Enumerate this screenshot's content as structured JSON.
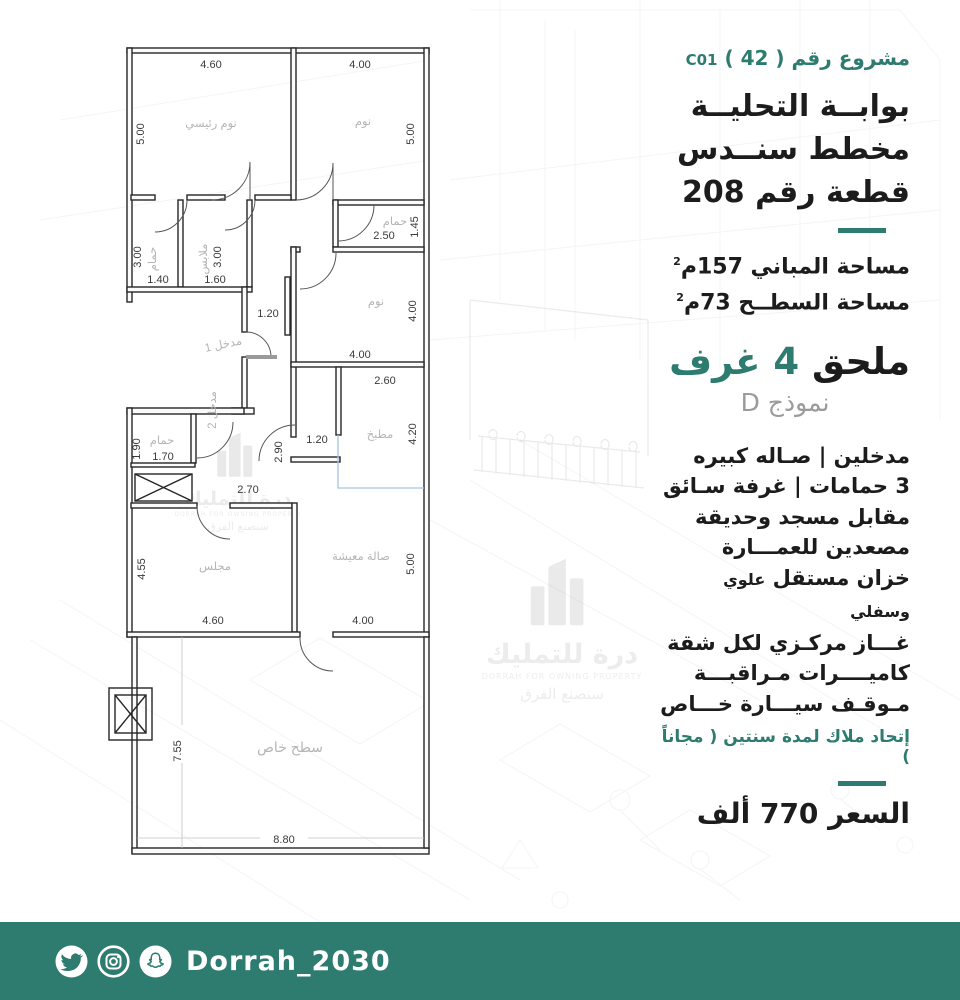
{
  "accent": "#2e7b70",
  "plan": {
    "rooms": {
      "master": "نوم رئيسي",
      "bed": "نوم",
      "bath": "حمام",
      "closet": "ملابس",
      "kitchen": "مطبخ",
      "entrance1": "مدخل 1",
      "entrance2": "مدخل 2",
      "majlis": "مجلس",
      "living": "صالة معيشة",
      "roof": "سطح خاص"
    },
    "dims": {
      "m_top": "4.60",
      "m_left": "5.00",
      "b_top": "4.00",
      "b_right": "5.00",
      "wc1_h": "3.00",
      "wc1_w": "1.40",
      "cl_h": "3.00",
      "cl_w": "1.60",
      "wc2_w": "2.50",
      "wc2_h": "1.45",
      "mb_h": "4.00",
      "mb_w": "4.00",
      "k_w": "2.60",
      "k_h": "4.20",
      "ent_w": "1.20",
      "hall_h": "2.90",
      "hall_gap": "1.20",
      "hall_w": "2.70",
      "wc3_h": "1.90",
      "wc3_w": "1.70",
      "mj_h": "4.55",
      "mj_w": "4.60",
      "lv_h": "5.00",
      "lv_w": "4.00",
      "rf_h": "7.55",
      "rf_w": "8.80"
    }
  },
  "panel": {
    "project_ar": "مشروع رقم ( 42 )",
    "project_code": "C01",
    "title1": "بوابــة التحليــة",
    "title2": "مخطط سنــدس",
    "title3": "قطعة رقم 208",
    "area1": "مساحة المباني 157م",
    "area1_sup": "2",
    "area2": "مساحة السطــح 73م",
    "area2_sup": "2",
    "annex_black": "ملحق",
    "annex_teal": "4 غرف",
    "model": "نموذج D",
    "features": [
      "مدخلين  |  صـاله كبيره",
      "3 حمامات | غرفة سـائق",
      "مقابل مسجد وحديقة",
      "مصعدين  للعمـــارة",
      {
        "main": "خزان مستقل",
        "small": "علوي وسفلي"
      },
      "غـــاز مركـزي لكل شقة",
      "كاميــــرات مـراقبـــة",
      "مـوقـف سيـــارة خـــاص"
    ],
    "union_note": "إتحاد ملاك لمدة سنتين ( مجاناً )",
    "price": "السعر  770  ألف"
  },
  "watermark": {
    "brand_ar": "درة للتمليك",
    "brand_en": "DORRAH FOR OWNING PROPERTY",
    "tagline": "سنصنع الفرق"
  },
  "footer": {
    "handle": "Dorrah_2030"
  }
}
